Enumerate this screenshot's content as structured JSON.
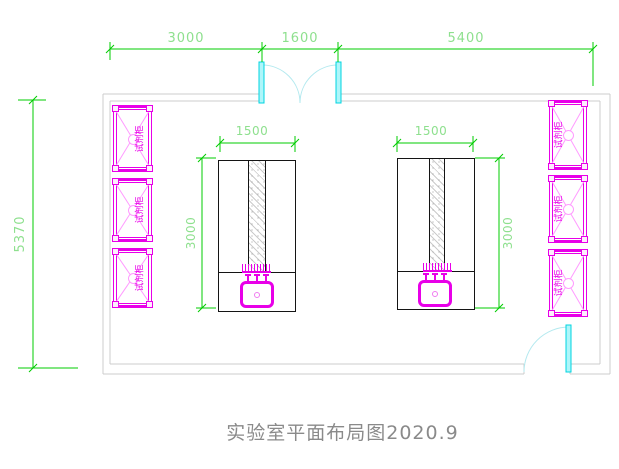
{
  "drawing": {
    "title": "实验室平面布局图2020.9",
    "type": "laboratory-floor-plan"
  },
  "dimensions": {
    "top": [
      "3000",
      "1600",
      "5400"
    ],
    "overall_depth": "5370",
    "benches": {
      "left": {
        "width": "1500",
        "depth": "3000"
      },
      "right": {
        "width": "1500",
        "depth": "3000"
      }
    }
  },
  "cabinets": {
    "label": "试剂柜",
    "count_left": 3,
    "count_right": 3
  },
  "doors": {
    "top_double_door_width": "1600",
    "bottom_right_door": "single-swing"
  },
  "colors": {
    "dimension_line": "#00cc00",
    "dimension_text": "#8ee08e",
    "cabinet": "#e800e8",
    "cabinet_hatch": "#ff9bff",
    "door_leaf": "#00d4e0",
    "door_arc": "#b3e9ef",
    "wall": "#cccccc",
    "bench_outline": "#141414",
    "title_text": "#8a8a8a"
  }
}
